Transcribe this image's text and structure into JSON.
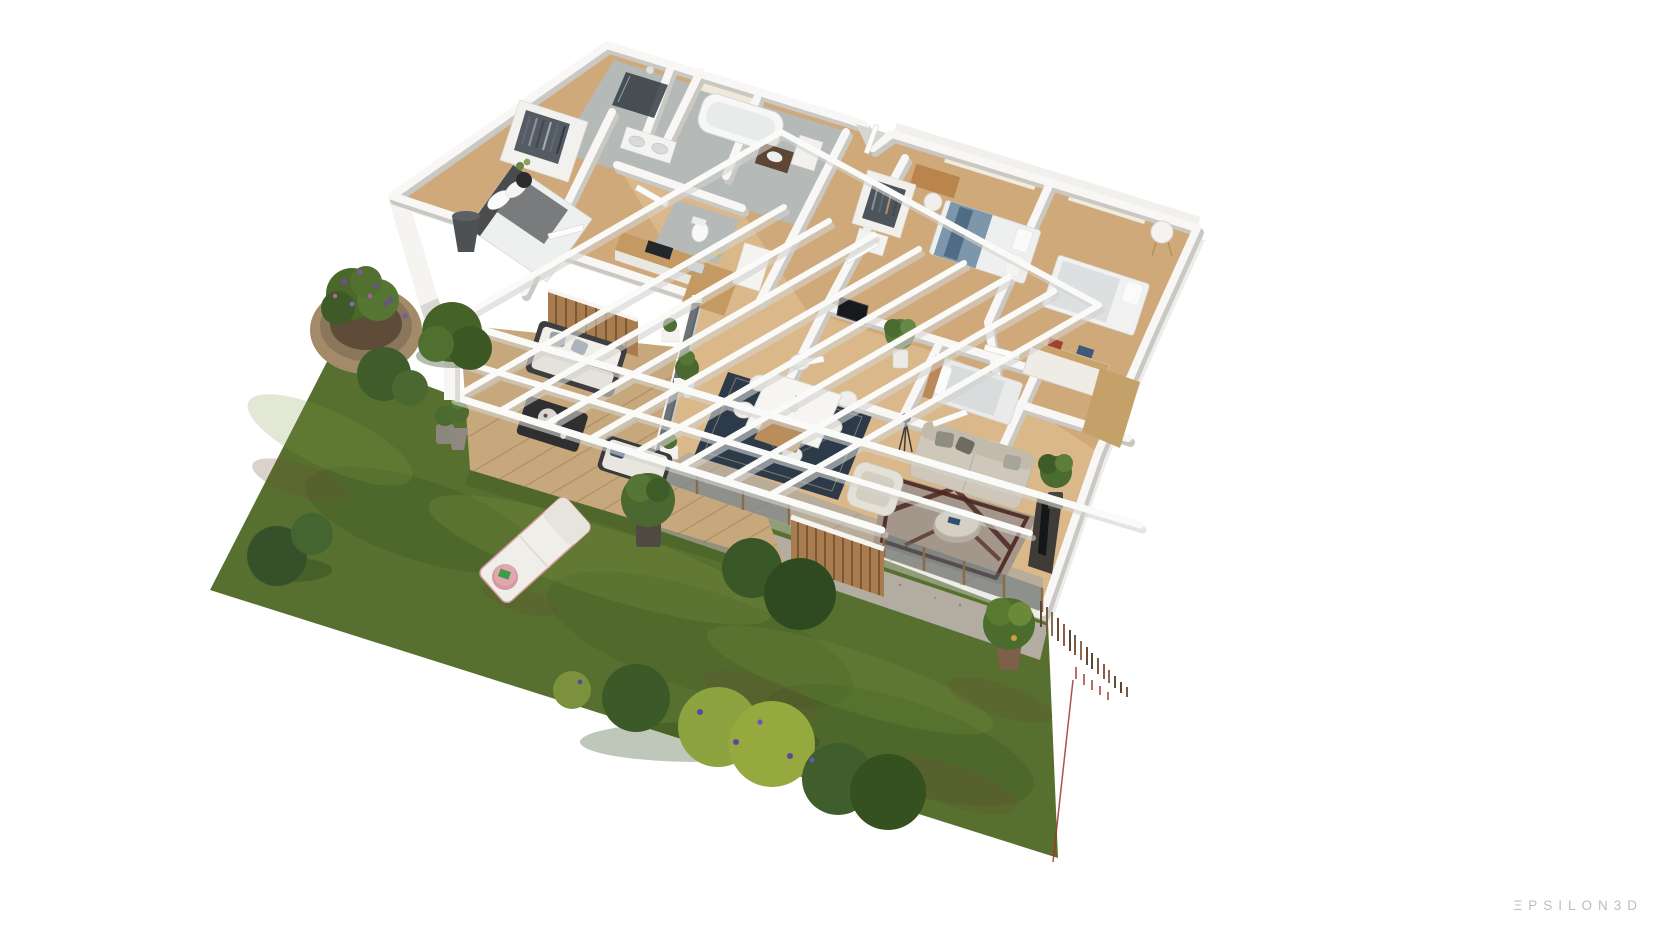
{
  "watermark": {
    "text": "ΞPSILON3D"
  },
  "palette": {
    "background": "#ffffff",
    "grass": "#57702f",
    "grass_dark": "#2f4a1e",
    "grass_brown": "#6b4f33",
    "deck_wood": "#c7a87c",
    "deck_line": "#9b7a4e",
    "floor_wood": "#cfa97a",
    "floor_wood_light": "#ecd3a4",
    "terrace_gray": "#b9ac99",
    "tile": "#b5b9b7",
    "wall": "#f8f7f5",
    "wall_shadow": "#c9c8c3",
    "slab_shadow": "#d8d7d3",
    "pergola": "#fafaf8",
    "rug_navy": "#2d3a4a",
    "rug_navy_pattern": "#c8b98a",
    "rug_living": "#a2978a",
    "rug_living_pattern": "#4e2620",
    "sofa": "#cfc8ba",
    "armchair": "#e3e0d8",
    "bed_linen": "#eef0ef",
    "blanket_blue": "#7e96ab",
    "headboard_dark": "#4a4c4e",
    "kitchen_wood": "#c59a62",
    "gravel": "#b3aca0",
    "glass": "#5c707a",
    "slat_wood": "#a87c4e",
    "stone_planter": "#a38b69",
    "bush_green": "#3f5d2a",
    "bush_yellowgreen": "#8da33f",
    "lounger_pink": "#d799a0",
    "fence_brown": "#6b4a33",
    "property_line": "#a23527",
    "watermark": "#bdbdbd"
  },
  "scene": {
    "rooms": [
      "master-bedroom",
      "shower-room",
      "bathroom",
      "double-vanity-wc",
      "second-bathroom",
      "wc",
      "hallway",
      "kitchen",
      "dining-area",
      "living-room",
      "tv-room",
      "kids-bedroom",
      "bedroom-2",
      "bedroom-3",
      "terrace",
      "wood-deck",
      "garden"
    ],
    "furniture": [
      "double-bed",
      "wardrobe",
      "cone-floor-lamp",
      "bathtub",
      "shower",
      "vanity-sinks",
      "kitchen-counter",
      "dining-table",
      "dining-chairs",
      "navy-rug",
      "beige-sofa",
      "white-armchair",
      "round-coffee-table",
      "tripod-floor-lamp",
      "media-console",
      "desk-and-chair",
      "dresser-with-books",
      "single-bed",
      "drum-side-table",
      "outdoor-sofa",
      "outdoor-coffee-table",
      "outdoor-lounge-chair",
      "sun-lounger",
      "pink-side-table"
    ],
    "garden": [
      "lawn",
      "stone-planter",
      "trimmed-bushes",
      "flowering-shrubs",
      "potted-plants",
      "wooden-deck",
      "white-pergola",
      "slat-privacy-screen",
      "glass-balustrade",
      "gravel-path",
      "boundary-fence",
      "red-property-line"
    ]
  }
}
